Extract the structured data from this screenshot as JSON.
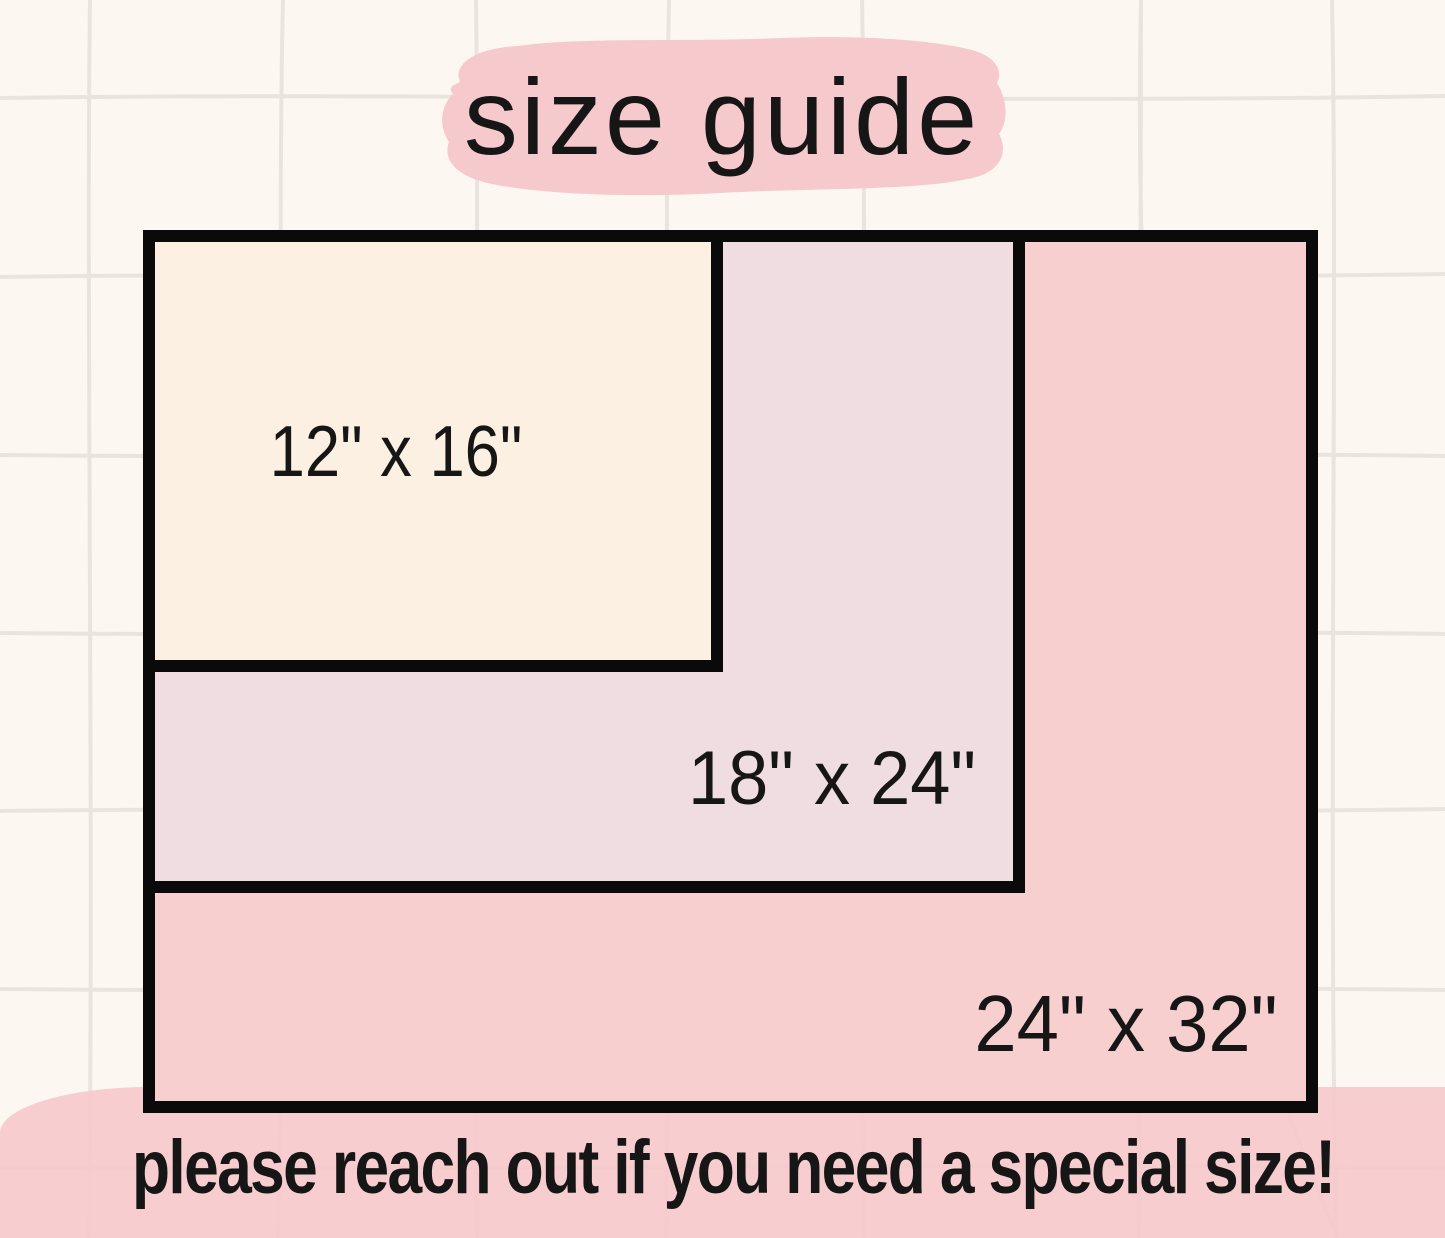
{
  "canvas": {
    "background_color": "#FDF7F1",
    "grid_line_color": "#E9E4DE",
    "border_color": "#0A0A0A",
    "text_color": "#161616"
  },
  "title": {
    "text": "size guide",
    "highlight_color": "#F6C9CC"
  },
  "sizes": [
    {
      "label": "12\" x 16\"",
      "width_in": 12,
      "height_in": 16,
      "fill_color": "#FCF0E2"
    },
    {
      "label": "18\" x 24\"",
      "width_in": 18,
      "height_in": 24,
      "fill_color": "#F0DDE1"
    },
    {
      "label": "24\" x 32\"",
      "width_in": 24,
      "height_in": 32,
      "fill_color": "#F8CFCF"
    }
  ],
  "footer": {
    "text": "please reach out if you need a special size!",
    "background_color": "rgba(246, 200, 204, 0.9)"
  }
}
